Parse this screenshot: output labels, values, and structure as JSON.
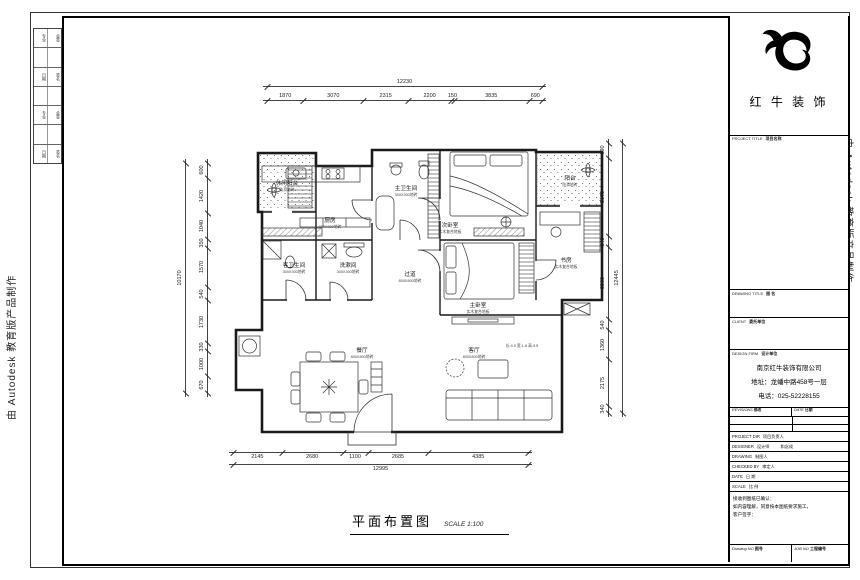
{
  "watermark": {
    "text": "由 Autodesk 教育版产品制作"
  },
  "title": {
    "name": "平面布置图",
    "scale": "SCALE 1:100"
  },
  "brand": {
    "logo_text": "红 牛 装 饰"
  },
  "titleblock": {
    "project_title_en": "PROJECT TITLE",
    "project_title_cn": "项目名称",
    "drawing_title_en": "DRAWING TITLE",
    "drawing_title_cn": "图 名",
    "client_en": "CLIENT",
    "client_cn": "委托单位",
    "firm_en": "DESIGN FIRM",
    "firm_cn": "设计单位",
    "firm_name": "南京红牛装饰有限公司",
    "firm_addr": "地址：龙蟠中路458号一层",
    "firm_tel": "电话：025-52228155",
    "revisions_en": "REVISIONS",
    "revisions_cn": "修改",
    "date_hdr_en": "DATE",
    "date_hdr_cn": "日期",
    "rows": [
      {
        "en": "PROJECT DIR",
        "cn": "项目负责人",
        "val": ""
      },
      {
        "en": "DESIGNER",
        "cn": "设计师",
        "val": "和念成"
      },
      {
        "en": "DRAWING",
        "cn": "制图人",
        "val": ""
      },
      {
        "en": "CHECKED BY",
        "cn": "审定人",
        "val": ""
      },
      {
        "en": "DATE",
        "cn": "日 期",
        "val": ""
      },
      {
        "en": "SCALE",
        "cn": "比 例",
        "val": ""
      }
    ],
    "note1": "接收到图纸已确认：",
    "note2": "如内容理解，同意按本图纸要求施工，",
    "note3": "客户签字：",
    "drawing_no_en": "Drawing NO",
    "drawing_no_cn": "图号",
    "job_no_en": "JOB NO",
    "job_no_cn": "工程编号"
  },
  "strip": {
    "rows": [
      {
        "a": "专业",
        "b": "会签"
      },
      {
        "a": "",
        "b": ""
      },
      {
        "a": "日期",
        "b": "签名"
      },
      {
        "a": "",
        "b": ""
      },
      {
        "a": "专业",
        "b": "会签"
      },
      {
        "a": "",
        "b": ""
      },
      {
        "a": "日期",
        "b": "签名"
      }
    ]
  },
  "rooms": [
    {
      "name": "厨房",
      "sub": "800X800地砖"
    },
    {
      "name": "主卫生间",
      "sub": "300X300地砖"
    },
    {
      "name": "次卧室",
      "sub": "实木复合地板"
    },
    {
      "name": "阳台",
      "sub": "防滑地砖"
    },
    {
      "name": "休闲阳台",
      "sub": "防滑地砖"
    },
    {
      "name": "主卧室",
      "sub": "实木复合地板"
    },
    {
      "name": "客卫生间",
      "sub": "300X300地砖"
    },
    {
      "name": "洗漱间",
      "sub": "300X300地砖"
    },
    {
      "name": "过道",
      "sub": "800X800地砖"
    },
    {
      "name": "餐厅",
      "sub": "800X800地砖"
    },
    {
      "name": "客厅",
      "sub": "800X800地砖"
    },
    {
      "name": "书房",
      "sub": "实木复合地板"
    }
  ],
  "annotation": "长:4.5 宽:1.8 高:3.5",
  "dims": {
    "top": {
      "segments": [
        "1870",
        "3070",
        "2315",
        "2200",
        "150",
        "3835",
        "690"
      ],
      "total": "12230"
    },
    "bottom": {
      "segments": [
        "2145",
        "2680",
        "1100",
        "2685",
        "4385"
      ],
      "total": "12995"
    },
    "left": {
      "segments": [
        "600",
        "1420",
        "1040",
        "350",
        "1570",
        "540",
        "1730",
        "330",
        "1000",
        "670"
      ],
      "total": "10170"
    },
    "right": {
      "segments": [
        "690",
        "3670",
        "540",
        "3360",
        "540",
        "1360",
        "2175",
        "340"
      ],
      "total": "12445"
    }
  }
}
